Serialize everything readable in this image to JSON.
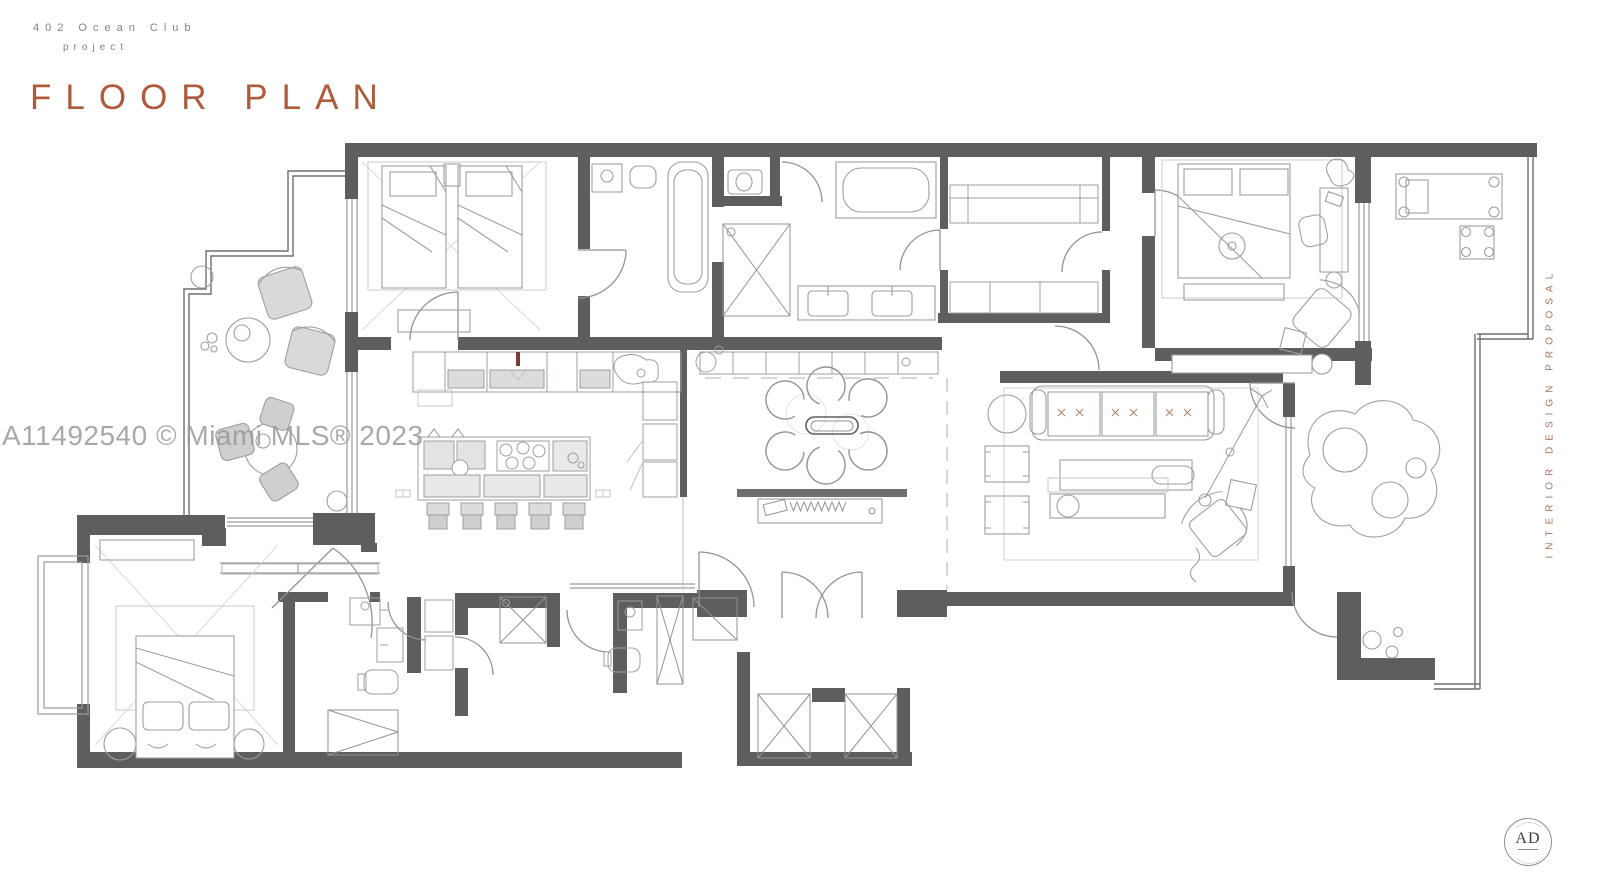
{
  "header": {
    "project_line1": "402 Ocean Club",
    "project_line2": "project",
    "title": "FLOOR PLAN"
  },
  "watermark": {
    "text": "A11492540 © Miami MLS® 2023"
  },
  "side_label": {
    "text": "INTERIOR DESIGN PROPOSAL"
  },
  "logo": {
    "monogram": "AD"
  },
  "colors": {
    "title": "#b05a3c",
    "eyebrow": "#8b8077",
    "side_label": "#a8735a",
    "watermark": "#9a9a9a",
    "wall": "#5e5e5e",
    "furniture_line": "#8f9496"
  }
}
